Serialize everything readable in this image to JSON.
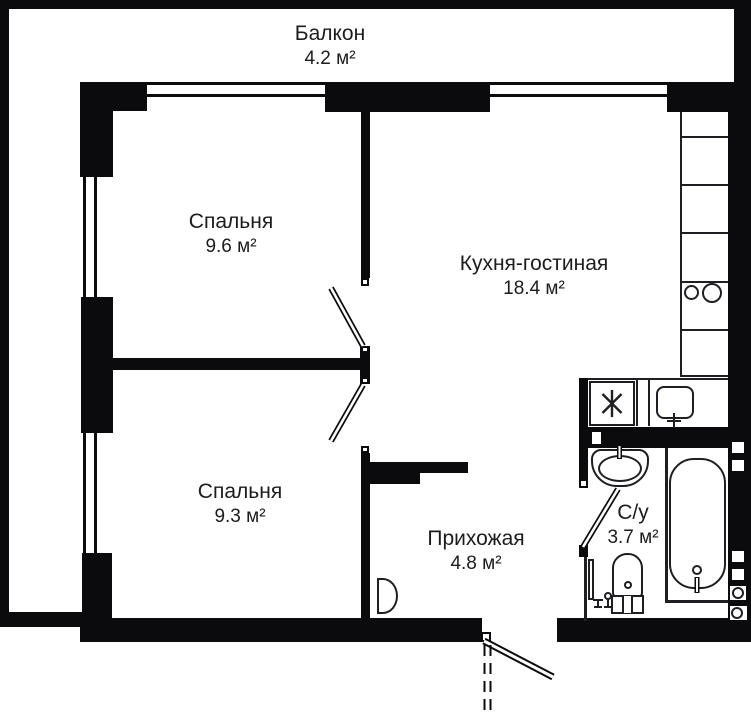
{
  "rooms": [
    {
      "id": "balcony",
      "name": "Балкон",
      "area": "4.2 м²"
    },
    {
      "id": "bedroom-1",
      "name": "Спальня",
      "area": "9.6 м²"
    },
    {
      "id": "kitchen-living",
      "name": "Кухня-гостиная",
      "area": "18.4 м²"
    },
    {
      "id": "bedroom-2",
      "name": "Спальня",
      "area": "9.3 м²"
    },
    {
      "id": "hallway",
      "name": "Прихожая",
      "area": "4.8 м²"
    },
    {
      "id": "bathroom",
      "name": "С/у",
      "area": "3.7 м²"
    }
  ],
  "colors": {
    "wall": "#0b0b0e",
    "line": "#1f1f23",
    "background": "#ffffff"
  },
  "fixtures": [
    "cooktop-icon",
    "kitchen-sink-icon",
    "washing-machine-icon",
    "bathtub-icon",
    "wash-basin-icon",
    "toilet-icon",
    "towel-rail-icon",
    "vent-shaft-icon",
    "riser-icon",
    "door-leaf-icon",
    "entrance-door-icon",
    "window-icon"
  ]
}
